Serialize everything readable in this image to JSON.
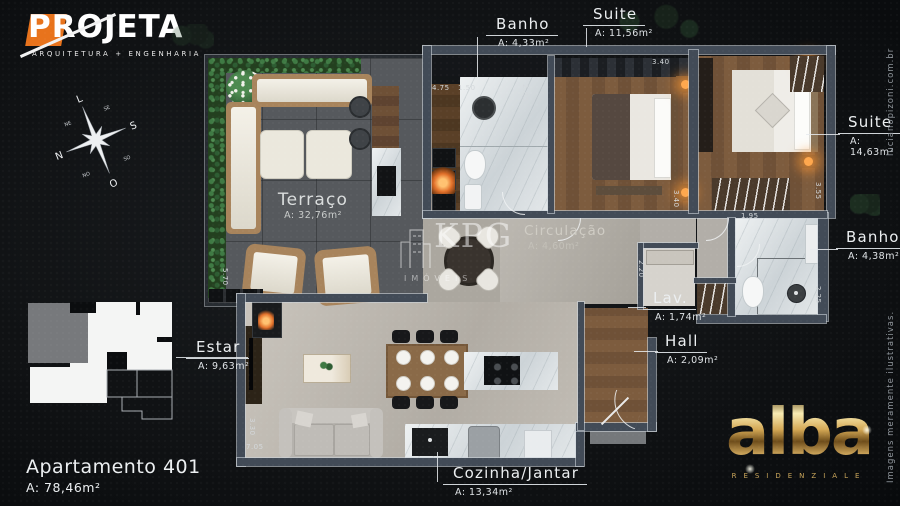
{
  "branding": {
    "projeta_name": "PROJETA",
    "projeta_tagline": "ARQUITETURA + ENGENHARIA",
    "alba_name": "alba",
    "alba_subtitle": "RESIDENZIALE"
  },
  "watermark": {
    "name": "KPG",
    "subtitle": "IMÓVEIS"
  },
  "unit": {
    "title": "Apartamento 401",
    "area": "A: 78,46m²"
  },
  "side_notes": {
    "website": "lucianopizoni.com.br",
    "disclaimer": "Imagens meramente ilustrativas."
  },
  "compass": {
    "top": "L",
    "right": "S",
    "bottom": "O",
    "left": "N",
    "ne": "NE",
    "se": "SE",
    "so": "SO",
    "no": "NO"
  },
  "rooms": {
    "banho1": {
      "label": "Banho",
      "area": "A: 4,33m²"
    },
    "suite1": {
      "label": "Suite",
      "area": "A: 11,56m²"
    },
    "suite2": {
      "label": "Suite",
      "area": "A: 14,63m²"
    },
    "banho2": {
      "label": "Banho",
      "area": "A: 4,38m²"
    },
    "terraco": {
      "label": "Terraço",
      "area": "A: 32,76m²"
    },
    "circulacao": {
      "label": "Circulação",
      "area": "A: 4,60m²"
    },
    "lav": {
      "label": "Lav.",
      "area": "A: 1,74m²"
    },
    "hall": {
      "label": "Hall",
      "area": "A: 2,09m²"
    },
    "estar": {
      "label": "Estar",
      "area": "A: 9,63m²"
    },
    "cozinha": {
      "label": "Cozinha/Jantar",
      "area": "A: 13,34m²"
    }
  },
  "dimensions": [
    "4.75",
    "1.50",
    "2.85",
    "3.40",
    "3.40",
    "3.55",
    "1.95",
    "2.25",
    "2.20",
    "5.70",
    "3.30",
    "7.05"
  ],
  "colors": {
    "accent_orange": "#e8731c",
    "gold": "#c9a55a",
    "wall_slate": "#424b57",
    "terrace_floor": "#56595d",
    "wood_floor": "#7d5c3e",
    "marble": "#e2e6e8"
  }
}
